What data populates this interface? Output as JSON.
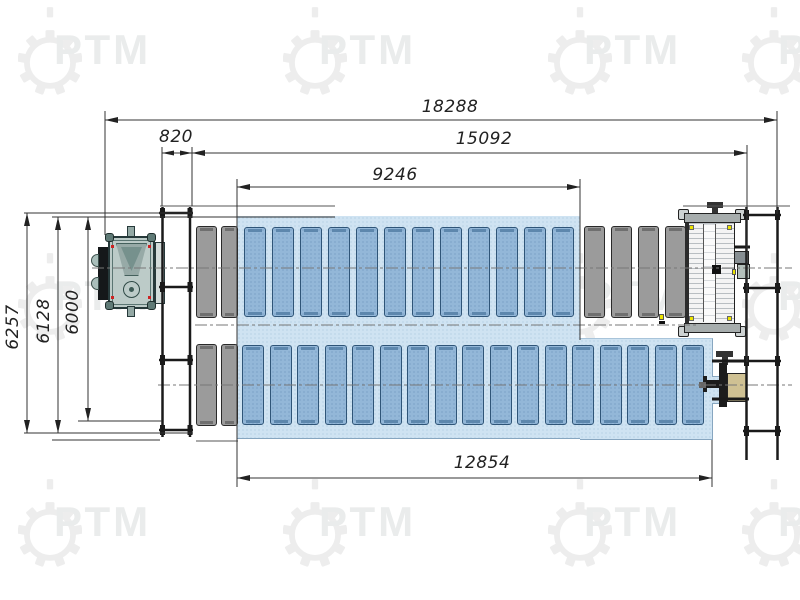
{
  "watermark": {
    "brand": "РТМ"
  },
  "dimensions": {
    "total_length": {
      "value": "18288"
    },
    "infeed_offset": {
      "value": "820"
    },
    "line_length": {
      "value": "15092"
    },
    "top_row_length": {
      "value": "9246"
    },
    "bottom_row_length": {
      "value": "12854"
    },
    "overall_width": {
      "value": "6257"
    },
    "mid_width": {
      "value": "6128"
    },
    "inner_width": {
      "value": "6000"
    }
  },
  "layout": {
    "top_row": {
      "gray_left_slats": 2,
      "blue_slats": 12,
      "gray_right_slats": 4
    },
    "bottom_row": {
      "gray_left_slats": 2,
      "blue_slats": 17
    }
  },
  "colors": {
    "zone_fill": "#cfe3f2",
    "zone_dot": "#a9c8e0",
    "blue_slat": "#93b7d8",
    "blue_slat_border": "#2f5578",
    "gray_slat": "#9b9b9b",
    "machine_body": "#b9cac6",
    "accent_yellow": "#e8e000",
    "tan_box": "#cfc193",
    "line": "#1a1a1a"
  }
}
